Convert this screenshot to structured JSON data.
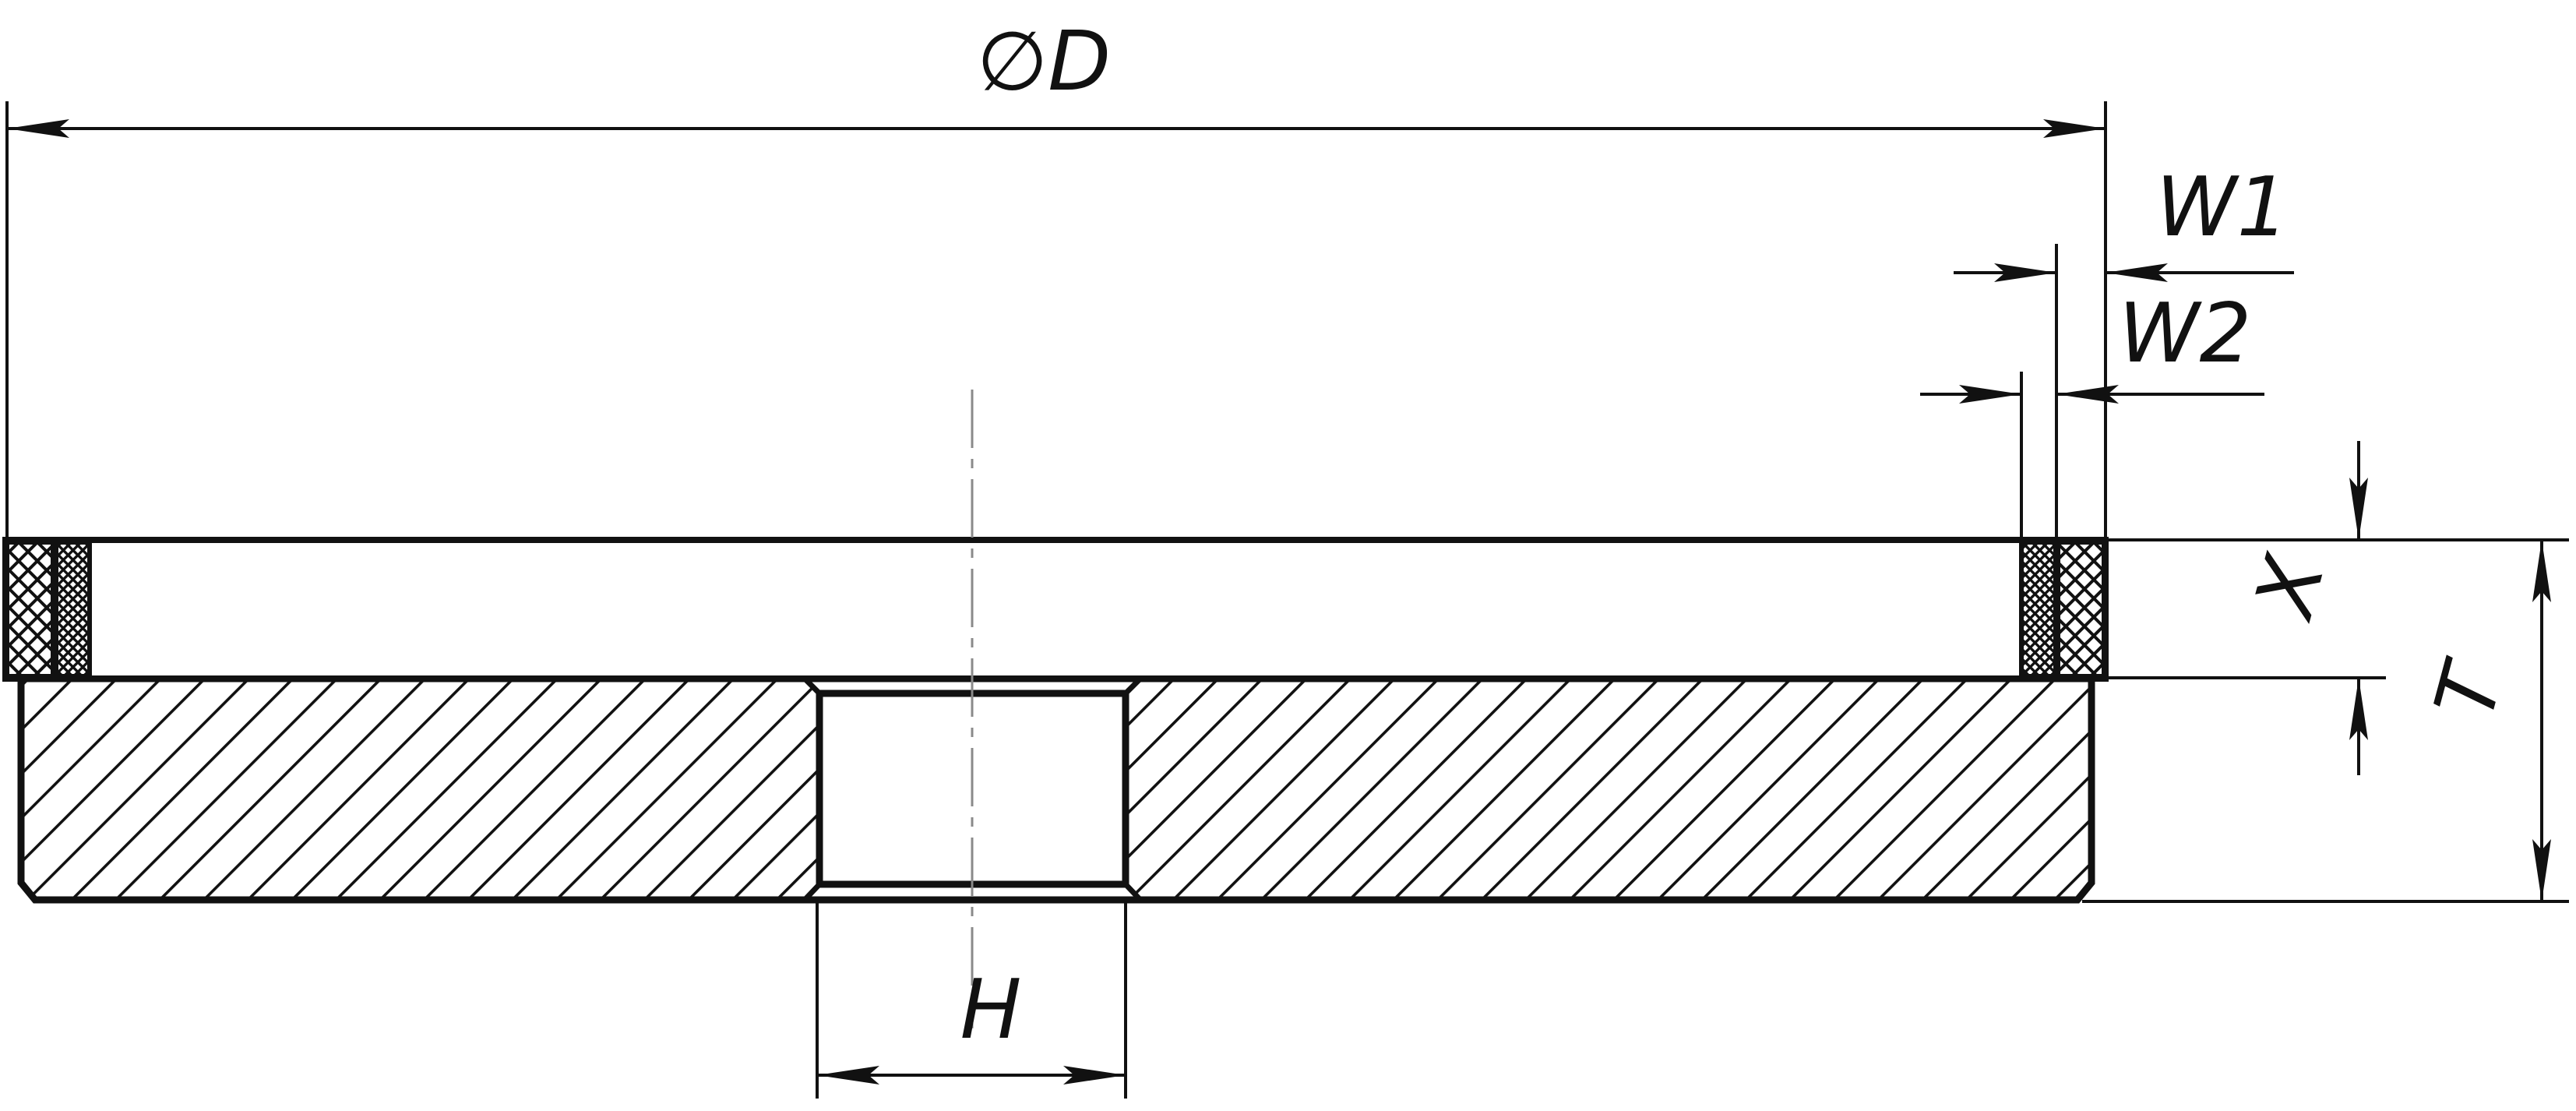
{
  "drawing": {
    "labels": {
      "diameter": "∅D",
      "w1": "W1",
      "w2": "W2",
      "x": "X",
      "t": "T",
      "h": "H"
    },
    "colors": {
      "line": "#111111",
      "centerline": "#8a8a8a",
      "background": "#ffffff"
    }
  }
}
